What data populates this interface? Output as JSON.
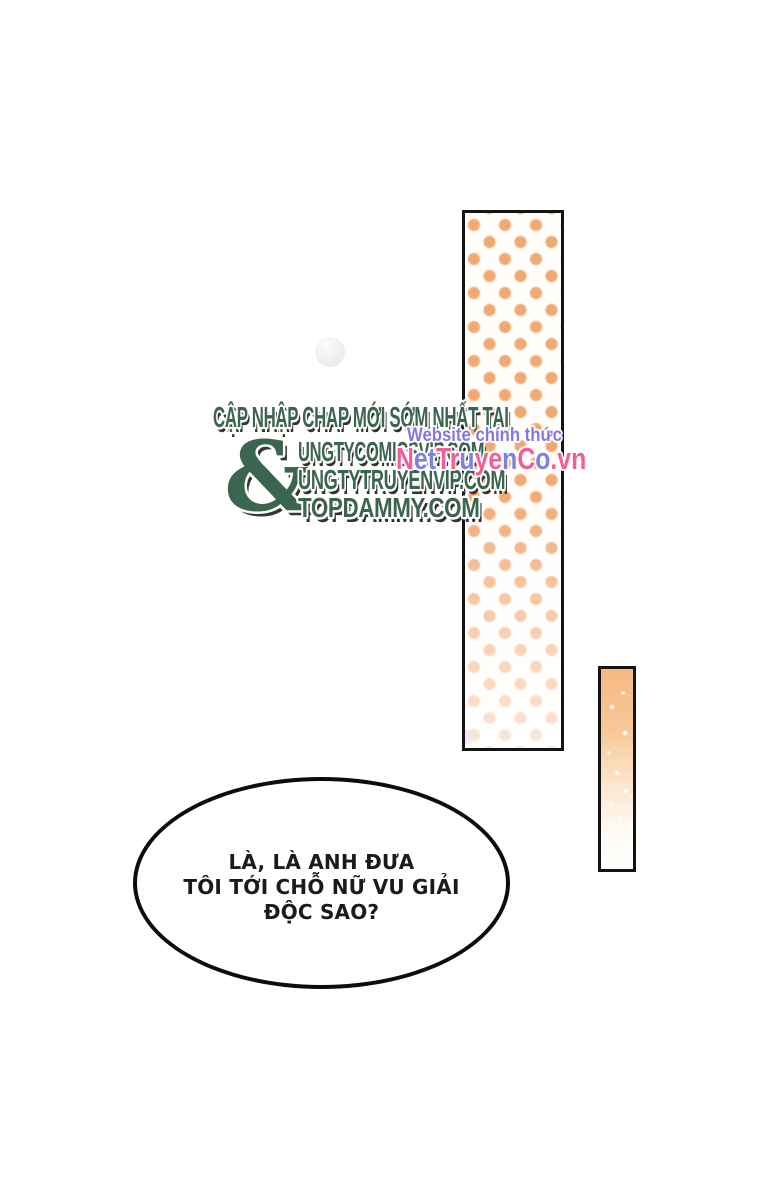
{
  "watermark_green": {
    "headline": "CẬP NHẬP CHAP MỚI SỚM NHẤT TẠI",
    "ampersand": "&",
    "sites": [
      "UNGTYCOMICSVIP.COM",
      "UNGTYTRUYENVIP.COM",
      "TOPDAMMY.COM"
    ],
    "text_color": "#3c654f"
  },
  "watermark_official": {
    "tagline": "Website chính thức",
    "tagline_color": "#8577e2",
    "logo_text": "NetTruyenCo.vn",
    "logo_letters": [
      {
        "ch": "N",
        "color": "#f25f98"
      },
      {
        "ch": "e",
        "color": "#7d82dc"
      },
      {
        "ch": "t",
        "color": "#7d82dc"
      },
      {
        "ch": "T",
        "color": "#f25f98"
      },
      {
        "ch": "r",
        "color": "#f25f98"
      },
      {
        "ch": "u",
        "color": "#7d82dc"
      },
      {
        "ch": "y",
        "color": "#f25f98"
      },
      {
        "ch": "e",
        "color": "#f25f98"
      },
      {
        "ch": "n",
        "color": "#7d82dc"
      },
      {
        "ch": "C",
        "color": "#f25f98"
      },
      {
        "ch": "o",
        "color": "#7d82dc"
      },
      {
        "ch": ".",
        "color": "#f25f98"
      },
      {
        "ch": "v",
        "color": "#f25f98"
      },
      {
        "ch": "n",
        "color": "#f25f98"
      }
    ]
  },
  "panels": {
    "polka_dot_color": "#f2a873",
    "gradient_top_color": "#f5ba82",
    "accent_pink_dot_color": "#eba6cb",
    "border_color": "#141414"
  },
  "speech_bubble": {
    "lines": [
      "LÀ, LÀ ANH ĐƯA",
      "TÔI TỚI CHỖ NỮ VU GIẢI",
      "ĐỘC SAO?"
    ]
  }
}
